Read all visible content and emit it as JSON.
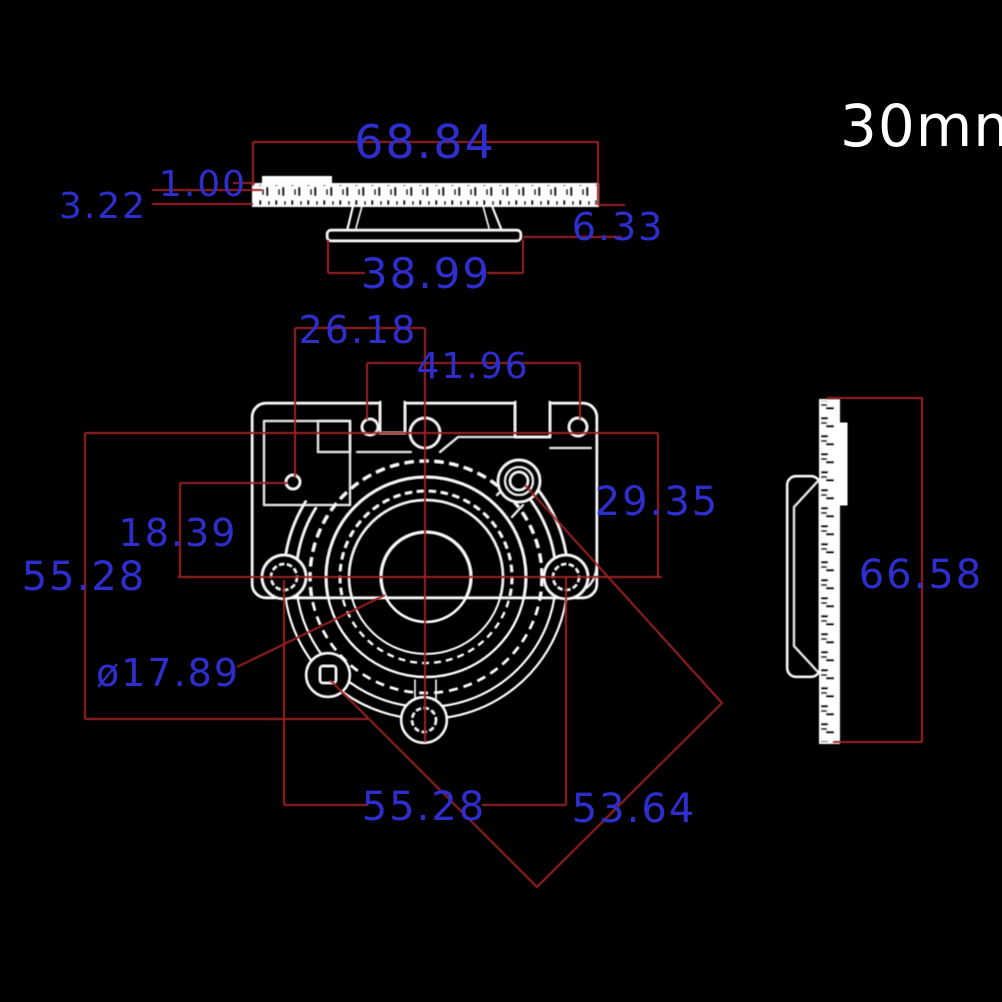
{
  "title": "30mm",
  "colors": {
    "background": "#000000",
    "geometry_white": "#ffffff",
    "dimension_line_red": "#9e2222",
    "dimension_text_blue": "#2e2ecf"
  },
  "dimensions": {
    "top_view": {
      "overall_width": "68.84",
      "lip_thickness": "1.00",
      "plate_thickness": "3.22",
      "cone_depth": "6.33",
      "cone_plate_width": "38.99"
    },
    "front_view": {
      "hole_offset_x": "26.18",
      "top_holes_span": "41.96",
      "hole_offset_y": "18.39",
      "center_to_top_holes": "29.35",
      "left_height": "55.28",
      "lens_diameter": "ø17.89",
      "bottom_holes_span": "55.28",
      "diagonal_span": "53.64"
    },
    "side_view": {
      "overall_height": "66.58"
    }
  }
}
